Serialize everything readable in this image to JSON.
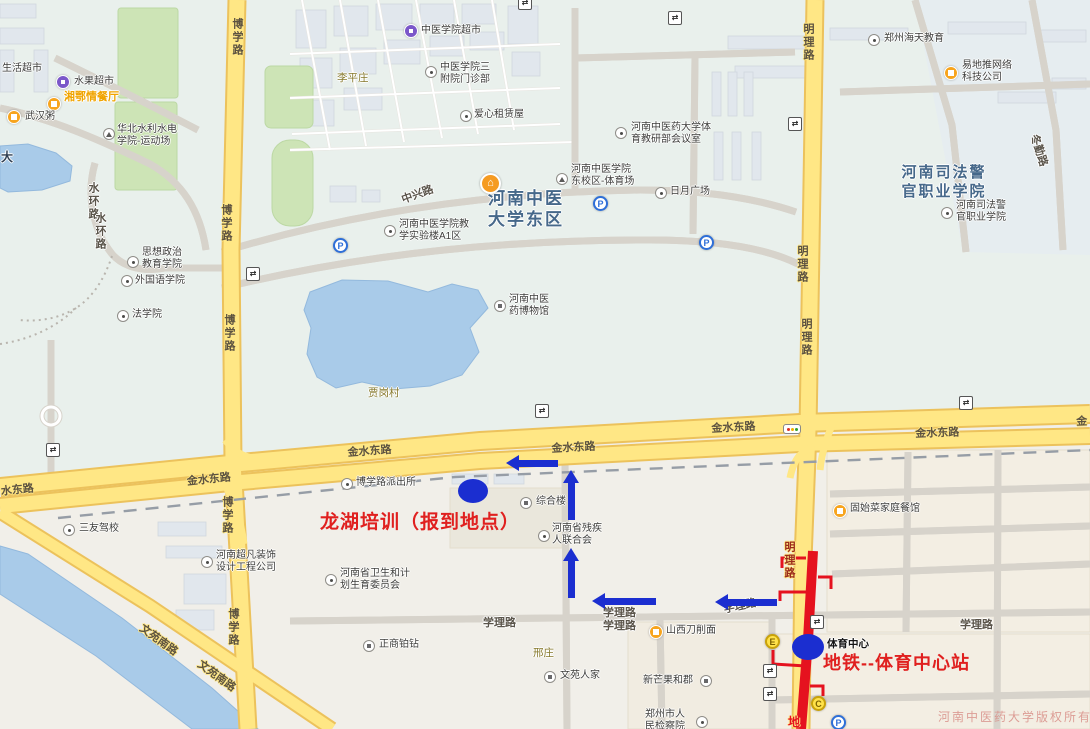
{
  "annotations": {
    "training": "龙湖培训（报到地点）",
    "metro": "地铁--体育中心站",
    "station": "体育中心",
    "watermark": "河南中医药大学版权所有",
    "partial_metro_char": "地"
  },
  "icons": {
    "parking": "P",
    "turn": "⇄",
    "house": "⌂"
  },
  "colors": {
    "annotation_blue": "#1b2ed0",
    "annotation_red": "#e0201f",
    "metro_line": "#e5121f",
    "road_fill": "#ffe785",
    "water": "#a9cbe9",
    "green": "#cde4b6"
  },
  "big_labels": [
    {
      "l1": "河南中医",
      "l2": "大学东区"
    },
    {
      "l1": "河南司法警",
      "l2": "官职业学院"
    }
  ],
  "pois": [
    {
      "n": [
        "生活超市"
      ],
      "icon": "none",
      "tx": 2,
      "ty": 63
    },
    {
      "n": [
        "水果超市"
      ],
      "icon": "shop",
      "ix": 63,
      "iy": 82,
      "tx": 74,
      "ty": 76
    },
    {
      "n": [
        "湘鄂情餐厅"
      ],
      "icon": "food",
      "ix": 54,
      "iy": 104,
      "tx": 64,
      "ty": 92,
      "sel": true
    },
    {
      "n": [
        "武汉粥"
      ],
      "icon": "food",
      "ix": 14,
      "iy": 117,
      "tx": 25,
      "ty": 111
    },
    {
      "n": [
        "华北水利水电",
        "学院-运动场"
      ],
      "icon": "sport",
      "ix": 109,
      "iy": 134,
      "tx": 117,
      "ty": 124
    },
    {
      "n": [
        "中医学院超市"
      ],
      "icon": "shop",
      "ix": 411,
      "iy": 31,
      "tx": 421,
      "ty": 25
    },
    {
      "n": [
        "中医学院三",
        "附院门诊部"
      ],
      "icon": "generic",
      "ix": 431,
      "iy": 72,
      "tx": 440,
      "ty": 62
    },
    {
      "n": [
        "爱心租赁屋"
      ],
      "icon": "generic",
      "ix": 466,
      "iy": 116,
      "tx": 474,
      "ty": 109
    },
    {
      "n": [
        "河南中医药大学体",
        "育教研部会议室"
      ],
      "icon": "generic",
      "ix": 621,
      "iy": 133,
      "tx": 631,
      "ty": 122
    },
    {
      "n": [
        "郑州海天教育"
      ],
      "icon": "generic",
      "ix": 874,
      "iy": 40,
      "tx": 884,
      "ty": 33
    },
    {
      "n": [
        "易地推网络",
        "科技公司"
      ],
      "icon": "food",
      "ix": 951,
      "iy": 73,
      "tx": 962,
      "ty": 60
    },
    {
      "n": [
        "河南中医学院",
        "东校区-体育场"
      ],
      "icon": "sport",
      "ix": 562,
      "iy": 179,
      "tx": 571,
      "ty": 164
    },
    {
      "n": [
        "日月广场"
      ],
      "icon": "generic",
      "ix": 661,
      "iy": 193,
      "tx": 670,
      "ty": 186
    },
    {
      "n": [
        "河南中医学院教",
        "学实验楼A1区"
      ],
      "icon": "generic",
      "ix": 390,
      "iy": 231,
      "tx": 399,
      "ty": 219
    },
    {
      "n": [
        "思想政治",
        "教育学院"
      ],
      "icon": "generic",
      "ix": 133,
      "iy": 262,
      "tx": 142,
      "ty": 247
    },
    {
      "n": [
        "外国语学院"
      ],
      "icon": "generic",
      "ix": 127,
      "iy": 281,
      "tx": 135,
      "ty": 275
    },
    {
      "n": [
        "法学院"
      ],
      "icon": "generic",
      "ix": 123,
      "iy": 316,
      "tx": 132,
      "ty": 309
    },
    {
      "n": [
        "河南中医",
        "药博物馆"
      ],
      "icon": "bld",
      "ix": 500,
      "iy": 306,
      "tx": 509,
      "ty": 294
    },
    {
      "n": [
        "河南司法警",
        "官职业学院"
      ],
      "icon": "generic",
      "ix": 947,
      "iy": 213,
      "tx": 956,
      "ty": 200
    },
    {
      "n": [
        "博学路派出所"
      ],
      "icon": "generic",
      "ix": 347,
      "iy": 484,
      "tx": 356,
      "ty": 477
    },
    {
      "n": [
        "综合楼"
      ],
      "icon": "bld",
      "ix": 526,
      "iy": 503,
      "tx": 536,
      "ty": 496
    },
    {
      "n": [
        "河南省残疾",
        "人联合会"
      ],
      "icon": "generic",
      "ix": 544,
      "iy": 536,
      "tx": 552,
      "ty": 523
    },
    {
      "n": [
        "河南省卫生和计",
        "划生育委员会"
      ],
      "icon": "generic",
      "ix": 331,
      "iy": 580,
      "tx": 340,
      "ty": 568
    },
    {
      "n": [
        "河南超凡装饰",
        "设计工程公司"
      ],
      "icon": "generic",
      "ix": 207,
      "iy": 562,
      "tx": 216,
      "ty": 550
    },
    {
      "n": [
        "三友驾校"
      ],
      "icon": "generic",
      "ix": 69,
      "iy": 530,
      "tx": 79,
      "ty": 523
    },
    {
      "n": [
        "正商铂钻"
      ],
      "icon": "bld",
      "ix": 369,
      "iy": 646,
      "tx": 379,
      "ty": 639
    },
    {
      "n": [
        "文苑人家"
      ],
      "icon": "bld",
      "ix": 550,
      "iy": 677,
      "tx": 560,
      "ty": 670
    },
    {
      "n": [
        "山西刀削面"
      ],
      "icon": "food",
      "ix": 656,
      "iy": 632,
      "tx": 666,
      "ty": 625
    },
    {
      "n": [
        "新芒果和郡"
      ],
      "icon": "bld",
      "ix": 706,
      "iy": 681,
      "tx": 643,
      "ty": 675
    },
    {
      "n": [
        "郑州市人",
        "民检察院"
      ],
      "icon": "generic",
      "ix": 702,
      "iy": 722,
      "tx": 645,
      "ty": 709
    },
    {
      "n": [
        "固始菜家庭餐馆"
      ],
      "icon": "food",
      "ix": 840,
      "iy": 511,
      "tx": 850,
      "ty": 503
    }
  ],
  "road_labels": [
    {
      "t": "水东路",
      "x": 0,
      "y": 483,
      "r": -6
    },
    {
      "t": "金水东路",
      "x": 186,
      "y": 473,
      "r": -6
    },
    {
      "t": "金水东路",
      "x": 347,
      "y": 444,
      "r": -4
    },
    {
      "t": "金水东路",
      "x": 551,
      "y": 440,
      "r": -3
    },
    {
      "t": "金水东路",
      "x": 711,
      "y": 420,
      "r": -3
    },
    {
      "t": "金水东路",
      "x": 915,
      "y": 425,
      "r": -2
    },
    {
      "t": "金",
      "x": 1076,
      "y": 413,
      "r": -2
    },
    {
      "t": "学理路",
      "x": 483,
      "y": 614,
      "w": true
    },
    {
      "t": "学理路",
      "x": 603,
      "y": 604,
      "w": true
    },
    {
      "t": "学理路",
      "x": 603,
      "y": 617,
      "w": true
    },
    {
      "t": "学理路",
      "x": 722,
      "y": 601,
      "r": -12,
      "w": true
    },
    {
      "t": "学理路",
      "x": 960,
      "y": 616,
      "w": true
    },
    {
      "t": "博学路",
      "x": 229,
      "y": 18,
      "v": true
    },
    {
      "t": "博学路",
      "x": 218,
      "y": 204,
      "v": true
    },
    {
      "t": "博学路",
      "x": 221,
      "y": 314,
      "v": true
    },
    {
      "t": "博学路",
      "x": 219,
      "y": 496,
      "v": true
    },
    {
      "t": "博学路",
      "x": 225,
      "y": 608,
      "v": true
    },
    {
      "t": "明理路",
      "x": 800,
      "y": 23,
      "v": true
    },
    {
      "t": "明理路",
      "x": 794,
      "y": 245,
      "v": true
    },
    {
      "t": "明理路",
      "x": 798,
      "y": 318,
      "v": true
    },
    {
      "t": "明理路",
      "x": 781,
      "y": 541,
      "v": true,
      "c": "red"
    },
    {
      "t": "水环路",
      "x": 85,
      "y": 182,
      "v": true,
      "w": true
    },
    {
      "t": "水环路",
      "x": 92,
      "y": 212,
      "v": true,
      "w": true
    },
    {
      "t": "中兴路",
      "x": 399,
      "y": 192,
      "r": -20,
      "w": true
    },
    {
      "t": "文苑南路",
      "x": 146,
      "y": 620,
      "r": 36
    },
    {
      "t": "文苑南路",
      "x": 204,
      "y": 656,
      "r": 36
    },
    {
      "t": "冬勤路",
      "x": 1042,
      "y": 132,
      "r": 72,
      "w": true
    }
  ],
  "village_labels": [
    {
      "t": "李平庄",
      "x": 337,
      "y": 70
    },
    {
      "t": "贾岗村",
      "x": 368,
      "y": 385
    },
    {
      "t": "邢庄",
      "x": 533,
      "y": 645
    }
  ],
  "misc_labels": [
    {
      "t": "大",
      "x": 1,
      "y": 148
    }
  ],
  "parking": [
    {
      "x": 340,
      "y": 245
    },
    {
      "x": 600,
      "y": 203
    },
    {
      "x": 706,
      "y": 242
    },
    {
      "x": 838,
      "y": 722
    }
  ],
  "exits": [
    {
      "t": "E",
      "x": 772,
      "y": 641
    },
    {
      "t": "C",
      "x": 818,
      "y": 703
    }
  ],
  "turns": [
    {
      "x": 524,
      "y": 2
    },
    {
      "x": 674,
      "y": 17
    },
    {
      "x": 794,
      "y": 123
    },
    {
      "x": 252,
      "y": 273
    },
    {
      "x": 52,
      "y": 449
    },
    {
      "x": 541,
      "y": 410
    },
    {
      "x": 965,
      "y": 402
    },
    {
      "x": 816,
      "y": 621
    },
    {
      "x": 769,
      "y": 670
    },
    {
      "x": 769,
      "y": 693
    }
  ],
  "dots": [
    {
      "x": 473,
      "y": 491,
      "rx": 15,
      "ry": 12
    },
    {
      "x": 808,
      "y": 647,
      "rx": 16,
      "ry": 13
    }
  ],
  "arrows": [
    {
      "dir": "left",
      "tipx": 506,
      "tipy": 463,
      "len": 52
    },
    {
      "dir": "up",
      "tipx": 571,
      "tipy": 470,
      "len": 50
    },
    {
      "dir": "up",
      "tipx": 571,
      "tipy": 548,
      "len": 50
    },
    {
      "dir": "left",
      "tipx": 592,
      "tipy": 601,
      "len": 64
    },
    {
      "dir": "left",
      "tipx": 715,
      "tipy": 602,
      "len": 62
    }
  ],
  "traffic_light": {
    "x": 791,
    "y": 428
  }
}
